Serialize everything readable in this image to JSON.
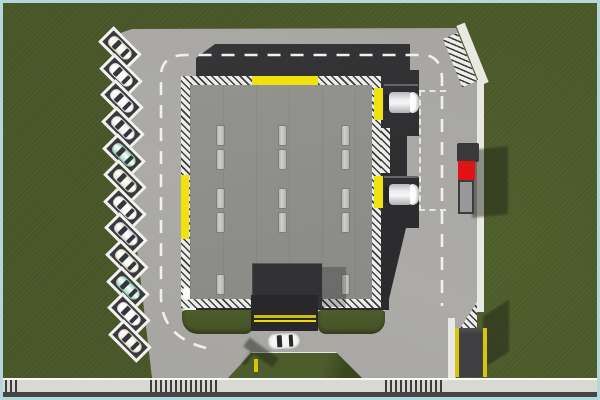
{
  "scene": {
    "description": "Top-down aerial view of a warehouse depot with loading docks, perimeter road, angled parking stalls and a highway along the bottom edge",
    "frame_color": "#b2d8da",
    "grass_color": "#4a5729",
    "pavement_color": "#a8a7a3",
    "sidewalk_color": "#e9e9e3",
    "highway": {
      "road_color": "#454547",
      "sidewalk_band_color": "#d9d9d3",
      "crossing_count": 3
    },
    "warehouse": {
      "roof_color": "#8e8e8b",
      "base_color": "#2e2e30",
      "hazard_yellow": "#f0e20e",
      "roof_vent_count": 14,
      "roof_vent_color": "#c6c6c2",
      "entrance_ramp_color": "#28282a",
      "ramp_stripe_color": "#e2d20c",
      "ramp_stripe_count": 2
    },
    "loading_docks": {
      "count": 2,
      "trailer_color": "#f2f2f2",
      "staging_box_style": "dashed white rectangle"
    },
    "parking": {
      "stall_count": 12,
      "stall_frame_color": "#f2f2ee",
      "stall_fill_color": "#3a3a3c",
      "car_colors": [
        "#f1ead0",
        "#fbfbfb",
        "#f4f5f7",
        "#ebebed",
        "#8fd4b6",
        "#efe9cc",
        "#fbfbfb",
        "#dfe0e3",
        "#f2ecd2",
        "#8fd4b6",
        "#fbfbfb",
        "#f0eacd"
      ]
    },
    "vehicles": {
      "red_cab_truck": {
        "cab_color": "#e01212",
        "trailer_color": "#98989a",
        "location": "right road shoulder"
      },
      "white_car": {
        "color": "#f6f6f4",
        "location": "south entrance driveway"
      }
    },
    "props": {
      "bollard_color": "#d6c50c",
      "shed_color": "#3f3f41",
      "shed_stripe_color": "#d8c60e"
    },
    "markings": {
      "lane_dash_color": "#f0f0ec"
    }
  }
}
